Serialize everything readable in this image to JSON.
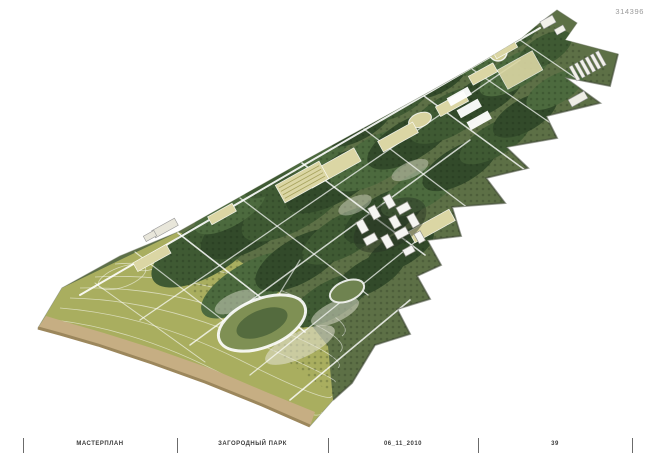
{
  "sheet": {
    "number": "314396",
    "footer": {
      "project_label": "МАСТЕРПЛАН",
      "sheet_title": "ЗАГОРОДНЫЙ ПАРК",
      "date": "06_11_2010",
      "page": "39"
    }
  },
  "illustration": {
    "kind": "axonometric-masterplan-rendering",
    "subject": "elongated country park strip with forest, meadow, beach edge, path network, circular lawn and building cluster"
  },
  "palette": {
    "background": "#ffffff",
    "meadow": "#a9ae5f",
    "sand": "#c6ae83",
    "sand_edge": "#9c875c",
    "forest_dark": "#324a2a",
    "forest_mid": "#3f5a33",
    "forest_light": "#4c6a3e",
    "base_green": "#5d7046",
    "lawn_beige": "#dbd6a4",
    "path_white": "#ffffff",
    "building_white": "#f5f5f2",
    "text_gray": "#9a9a9a",
    "text_dark": "#3c3c3c",
    "tick_gray": "#6b6b6b"
  }
}
